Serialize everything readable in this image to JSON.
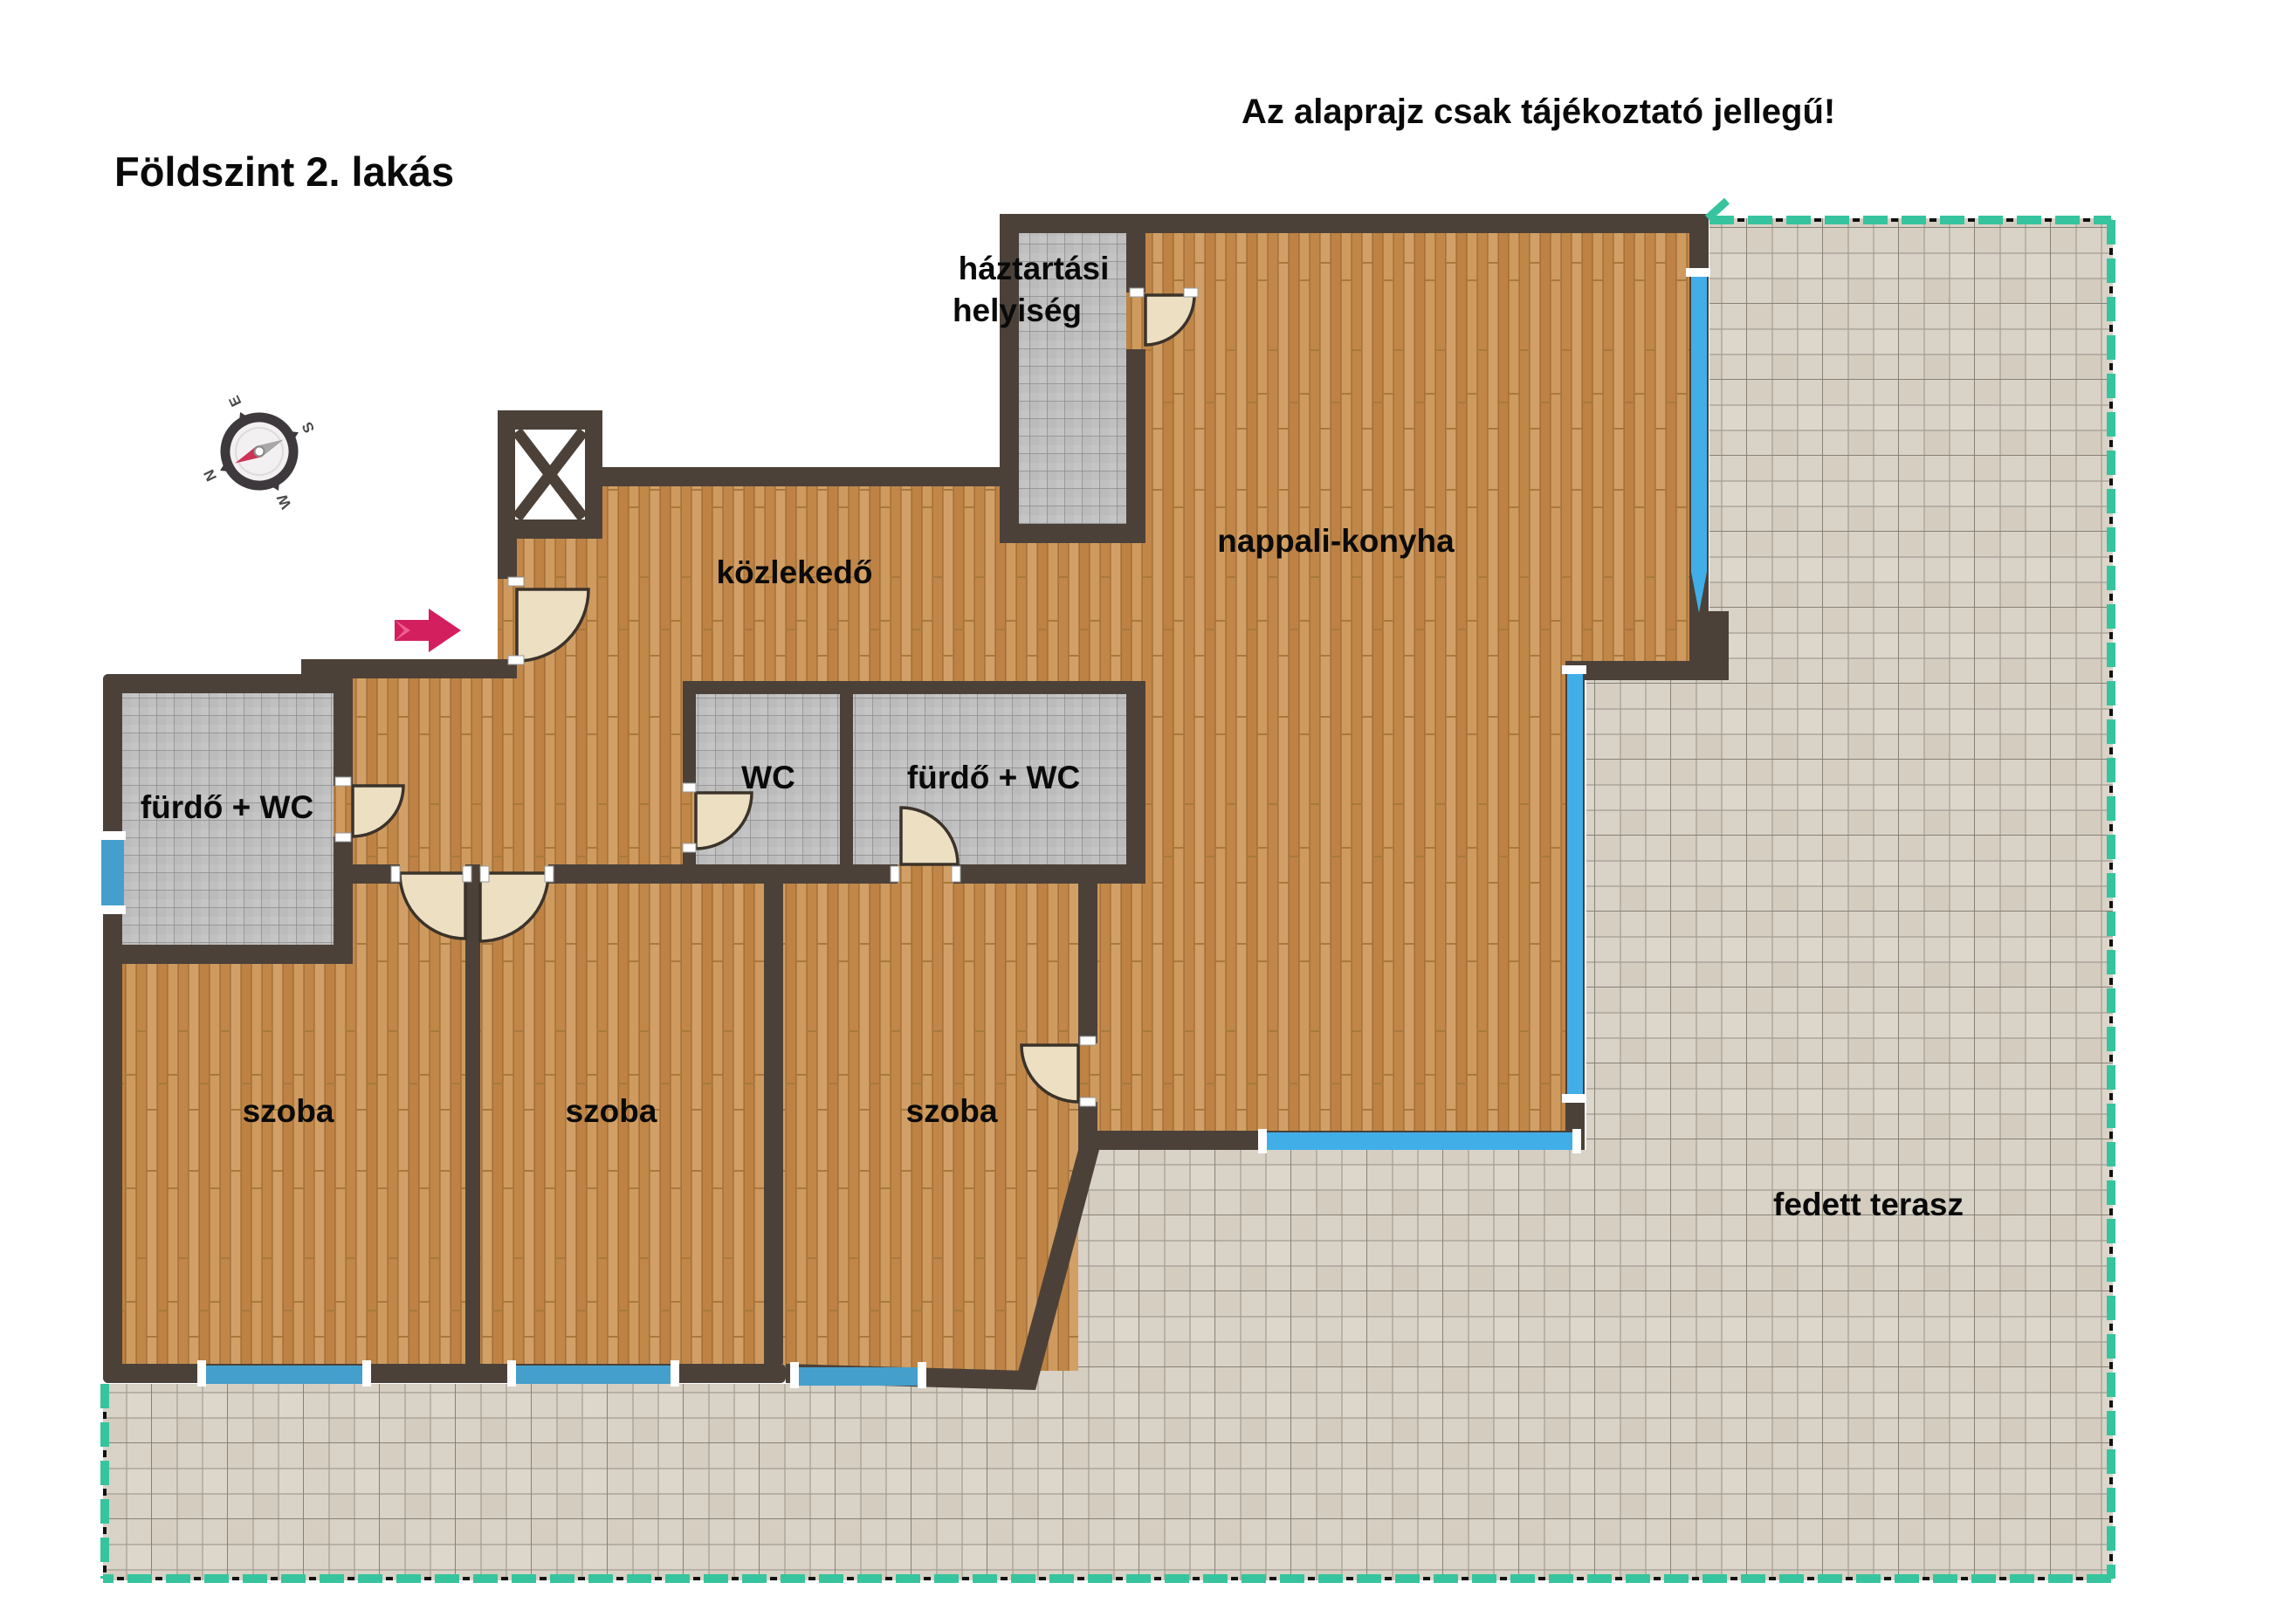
{
  "header": {
    "title": "Földszint 2. lakás",
    "disclaimer": "Az alaprajz csak tájékoztató jellegű!"
  },
  "rooms": {
    "utility_line1": "háztartási",
    "utility_line2": "helyiség",
    "hallway": "közlekedő",
    "living_kitchen": "nappali-konyha",
    "wc": "WC",
    "bath_mid": "fürdő + WC",
    "bath_left": "fürdő + WC",
    "terrace": "fedett terasz"
  },
  "bedrooms": [
    "szoba",
    "szoba",
    "szoba"
  ],
  "compass": {
    "n": "N",
    "e": "E",
    "s": "S",
    "w": "W"
  },
  "colors": {
    "wall": "#4b4139",
    "wood_floor": "#c8904e",
    "bath_tile": "#c1c0c0",
    "terrace_tile": "#d8d2c7",
    "window_blue_bright": "#41aee8",
    "window_blue_soft": "#459fcd",
    "boundary_green": "#36c49e",
    "entrance_arrow_red": "#d41f5f",
    "door_leaf": "#ecdfc2"
  }
}
